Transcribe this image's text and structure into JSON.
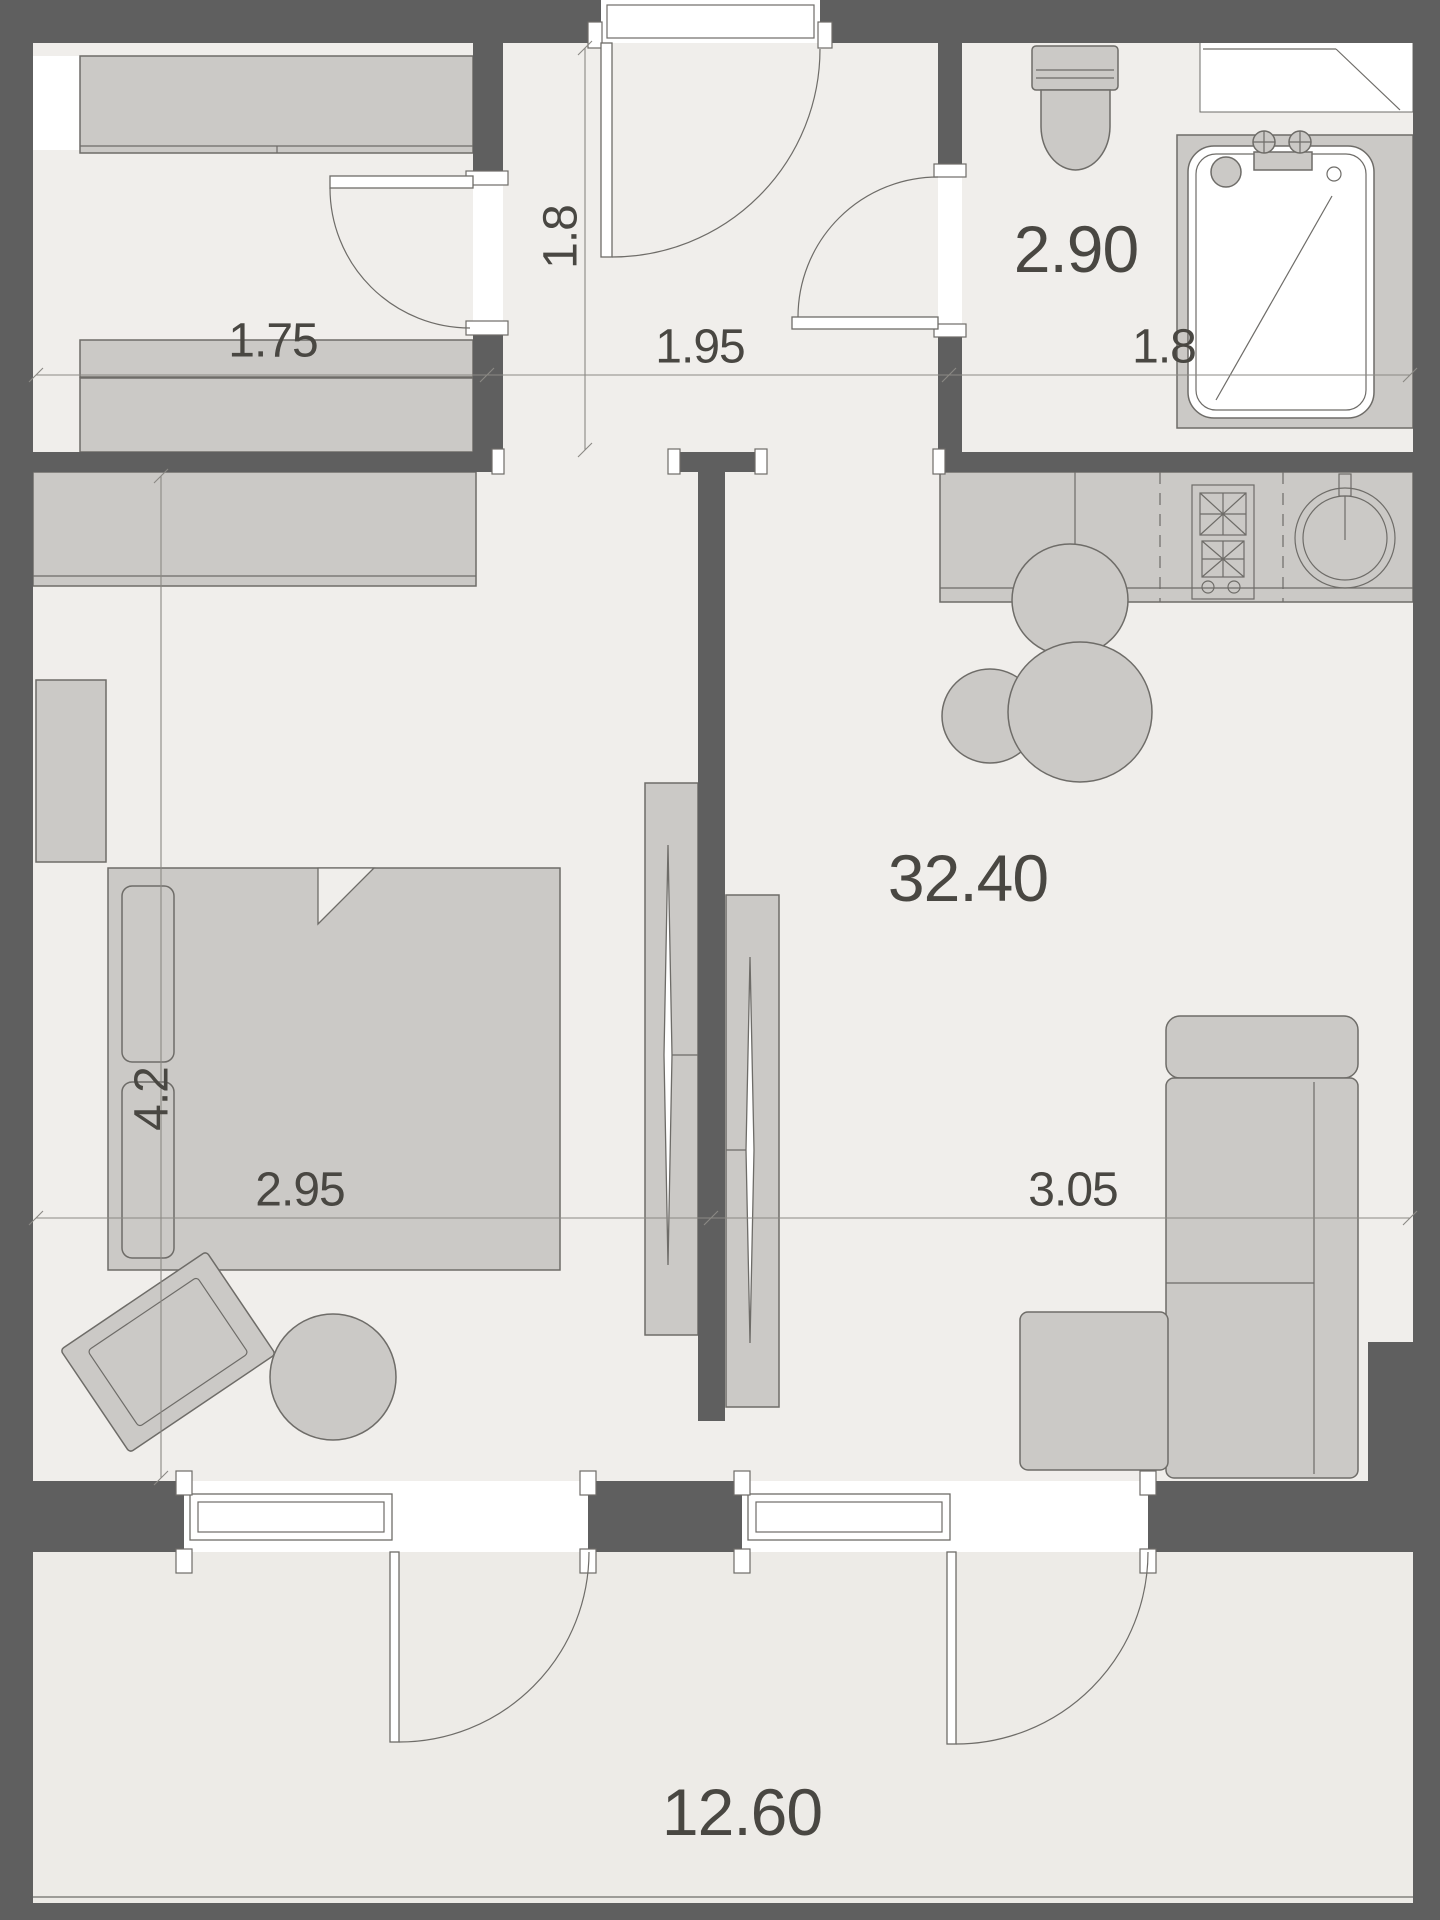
{
  "colors": {
    "wall": "#5f5f5f",
    "floor": "#f0eeeb",
    "balcony-floor": "#edebe7",
    "furniture": "#cbc9c6",
    "outline": "#6e6c68",
    "dimline": "#8b8984",
    "text": "#494742",
    "white": "#ffffff"
  },
  "labels": {
    "closet_width": "1.75",
    "hallway_width": "1.95",
    "hallway_depth": "1.8",
    "bathroom_area": "2.90",
    "bathroom_width": "1.8",
    "bedroom_depth": "4.2",
    "bedroom_width": "2.95",
    "living_area": "32.40",
    "living_width": "3.05",
    "balcony_area": "12.60"
  }
}
